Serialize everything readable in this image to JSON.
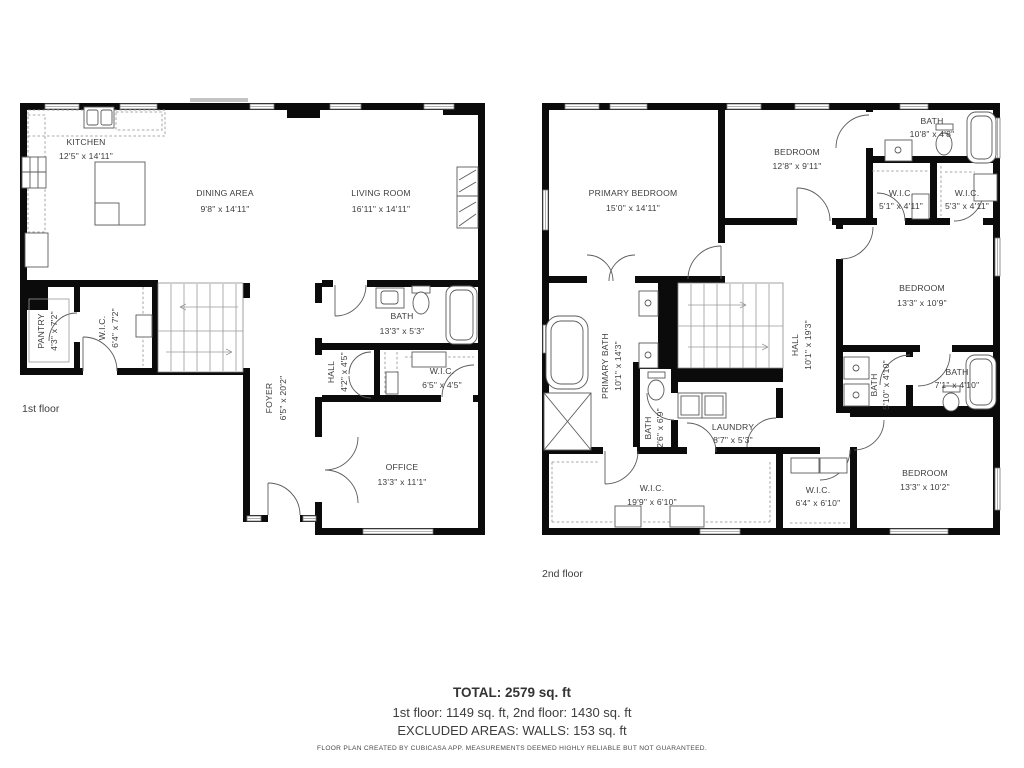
{
  "floor1": {
    "label": "1st floor",
    "rooms": {
      "kitchen": {
        "name": "KITCHEN",
        "dims": "12'5\" x 14'11\""
      },
      "dining": {
        "name": "DINING AREA",
        "dims": "9'8\" x 14'11\""
      },
      "living": {
        "name": "LIVING ROOM",
        "dims": "16'11\" x 14'11\""
      },
      "pantry": {
        "name": "PANTRY",
        "dims": "4'3\" x 7'2\""
      },
      "wic": {
        "name": "W.I.C.",
        "dims": "6'4\" x 7'2\""
      },
      "foyer": {
        "name": "FOYER",
        "dims": "6'5\" x 20'2\""
      },
      "bath": {
        "name": "BATH",
        "dims": "13'3\" x 5'3\""
      },
      "hall": {
        "name": "HALL",
        "dims": "4'2\" x 4'5\""
      },
      "wic2": {
        "name": "W.I.C.",
        "dims": "6'5\" x 4'5\""
      },
      "office": {
        "name": "OFFICE",
        "dims": "13'3\" x 11'1\""
      }
    }
  },
  "floor2": {
    "label": "2nd floor",
    "rooms": {
      "primary_bedroom": {
        "name": "PRIMARY BEDROOM",
        "dims": "15'0\" x 14'11\""
      },
      "bedroom_top": {
        "name": "BEDROOM",
        "dims": "12'8\" x 9'11\""
      },
      "bath_top": {
        "name": "BATH",
        "dims": "10'8\" x 4'8\""
      },
      "wic_a": {
        "name": "W.I.C.",
        "dims": "5'1\" x 4'11\""
      },
      "wic_b": {
        "name": "W.I.C.",
        "dims": "5'3\" x 4'11\""
      },
      "bedroom_right": {
        "name": "BEDROOM",
        "dims": "13'3\" x 10'9\""
      },
      "primary_bath": {
        "name": "PRIMARY BATH",
        "dims": "10'1\" x 14'3\""
      },
      "hall": {
        "name": "HALL",
        "dims": "10'1\" x 19'3\""
      },
      "bath_small": {
        "name": "BATH",
        "dims": "2'6\" x 6'9\""
      },
      "laundry": {
        "name": "LAUNDRY",
        "dims": "8'7\" x 5'3\""
      },
      "bath_c": {
        "name": "BATH",
        "dims": "5'10\" x 4'10\""
      },
      "bath_d": {
        "name": "BATH",
        "dims": "7'1\" x 4'10\""
      },
      "wic_big": {
        "name": "W.I.C.",
        "dims": "19'9\" x 6'10\""
      },
      "wic_small": {
        "name": "W.I.C.",
        "dims": "6'4\" x 6'10\""
      },
      "bedroom_bottom": {
        "name": "BEDROOM",
        "dims": "13'3\" x 10'2\""
      }
    }
  },
  "summary": {
    "total": "TOTAL: 2579 sq. ft",
    "floors": "1st floor: 1149 sq. ft, 2nd floor: 1430 sq. ft",
    "excluded": "EXCLUDED AREAS: WALLS: 153 sq. ft",
    "disclaimer": "FLOOR PLAN CREATED BY CUBICASA APP. MEASUREMENTS DEEMED HIGHLY RELIABLE BUT NOT GUARANTEED."
  },
  "colors": {
    "wall": "#0b0b0b",
    "text": "#3d3d3d"
  }
}
